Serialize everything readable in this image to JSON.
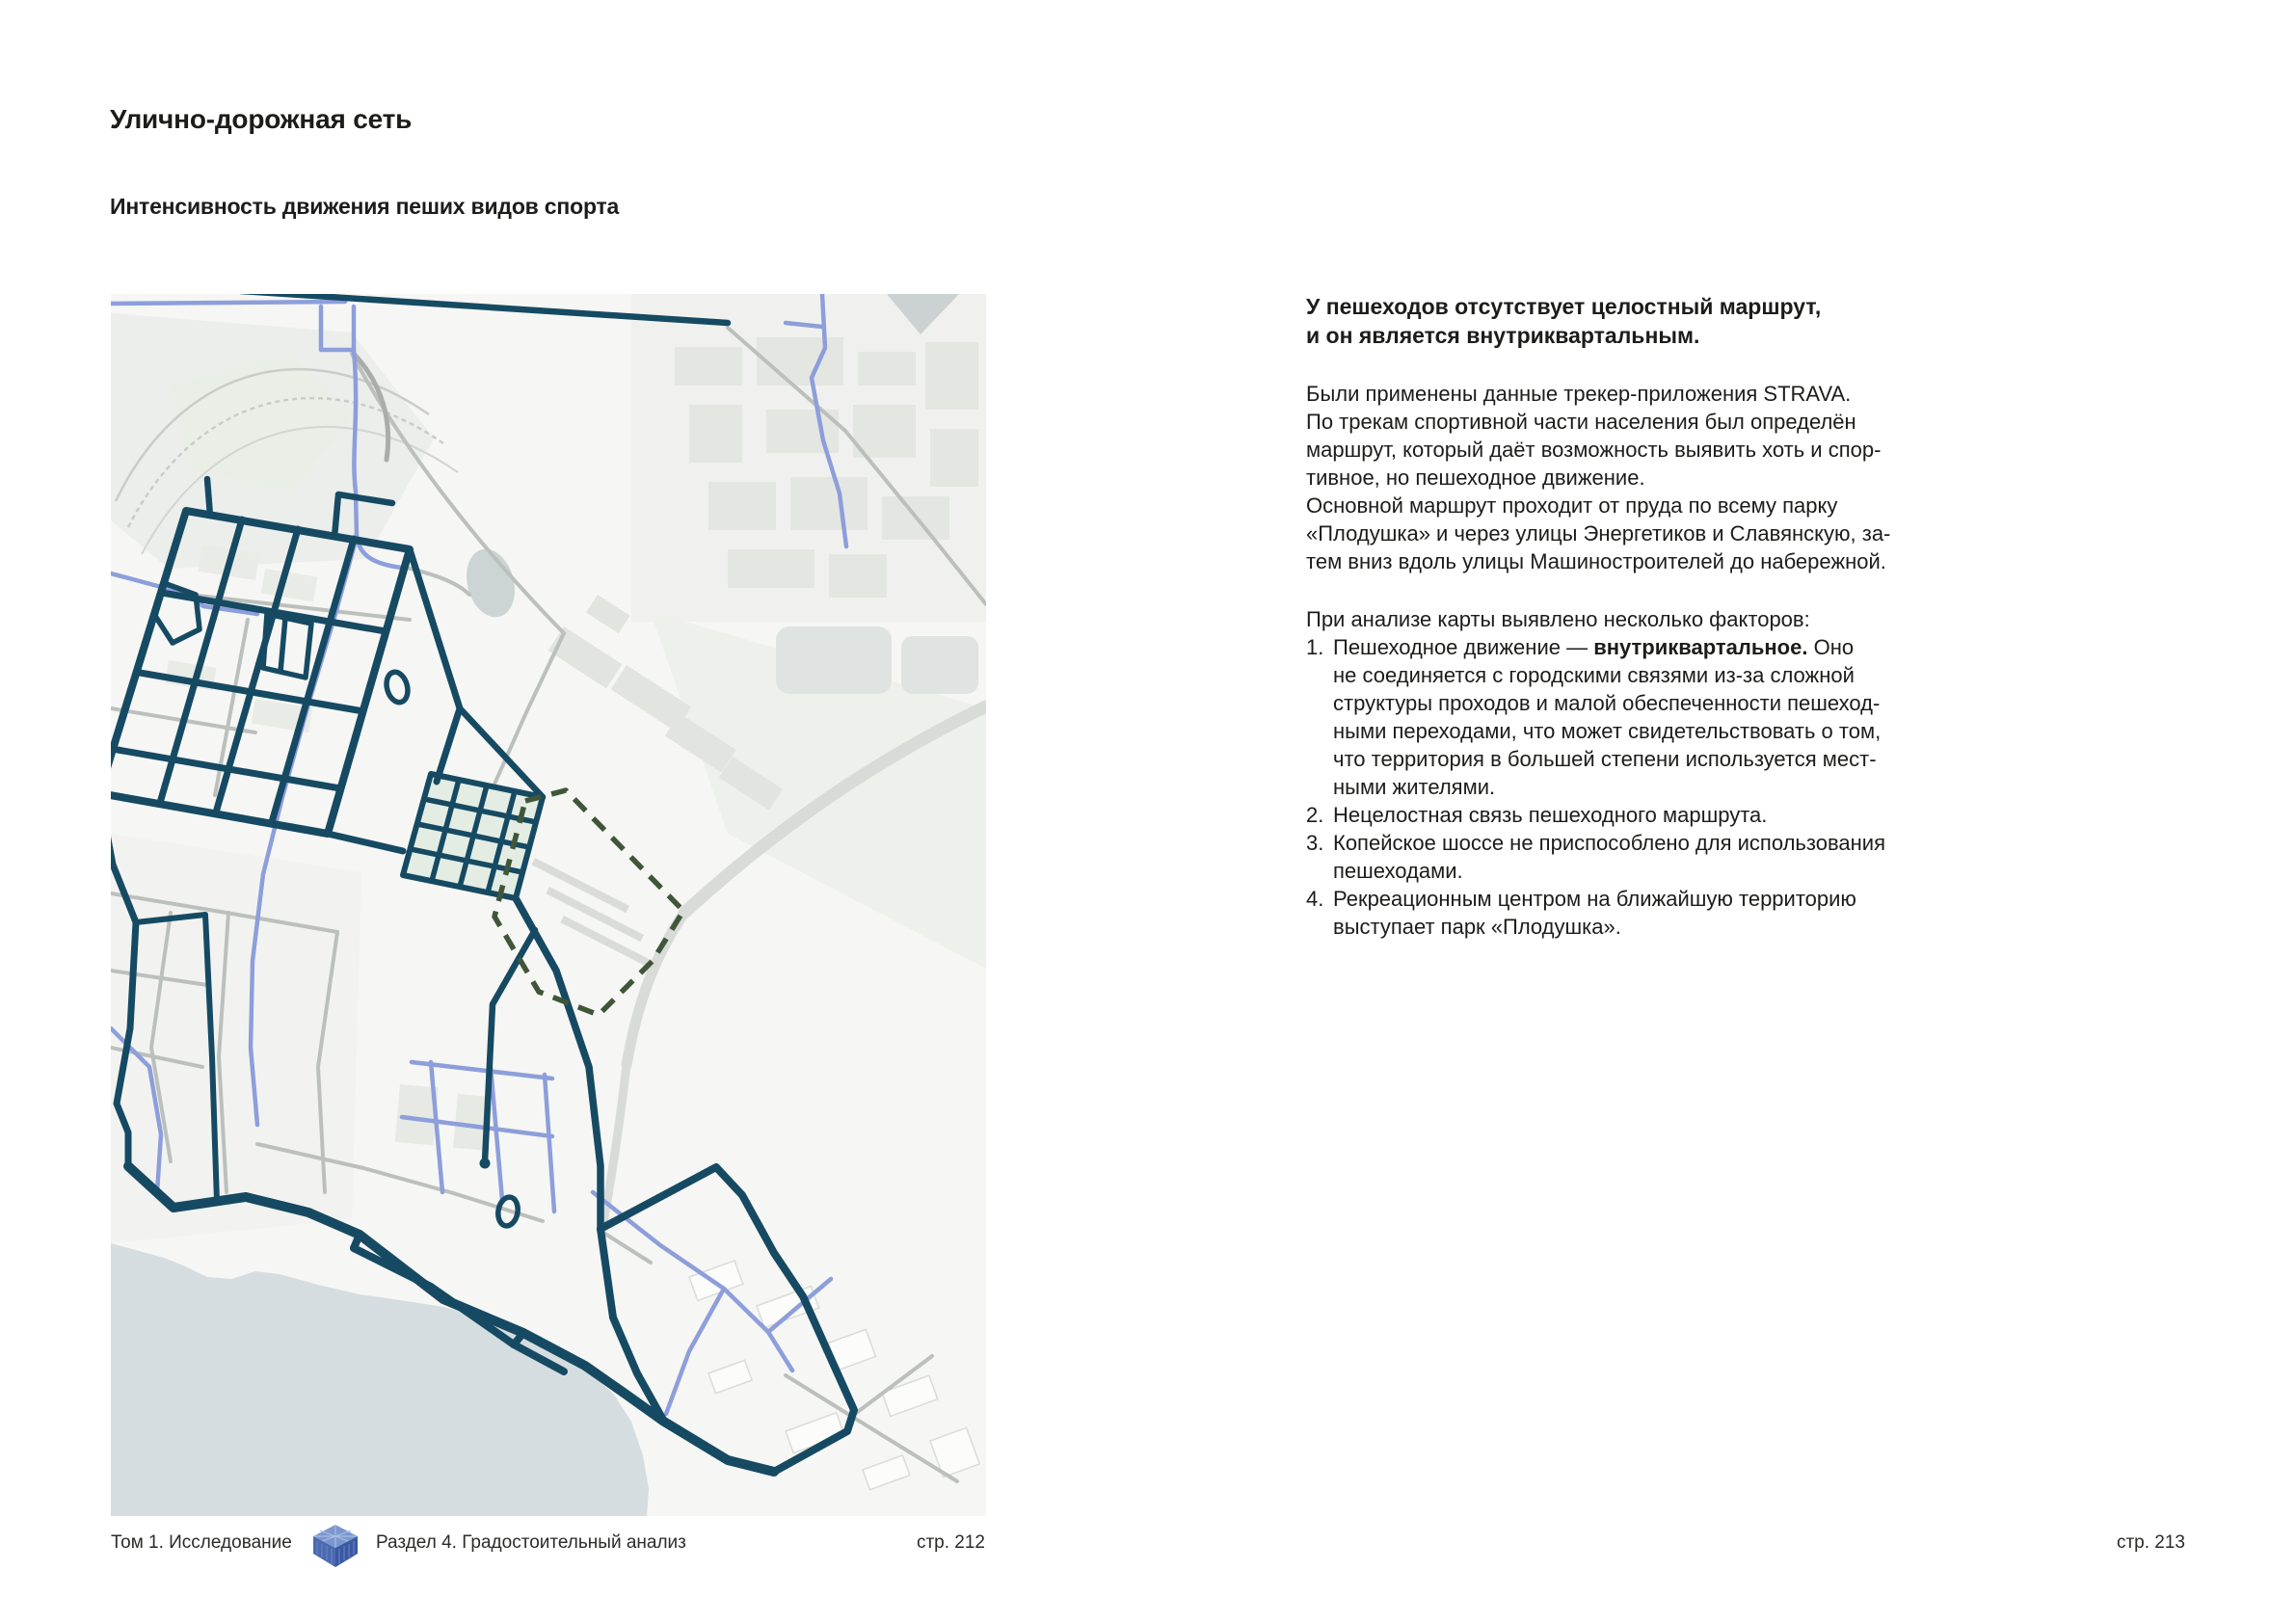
{
  "page": {
    "title": "Улично-дорожная сеть",
    "subtitle": "Интенсивность движения пеших видов спорта"
  },
  "article": {
    "lead": "У пешеходов отсутствует целостный маршрут,\nи он является внутриквартальным.",
    "paragraph": "Были применены данные трекер-приложения STRAVA.\nПо трекам спортивной части населения был определён\nмаршрут, который даёт возможность выявить хоть и спор-\nтивное, но пешеходное движение.\nОсновной маршрут проходит от пруда по всему парку\n«Плодушка» и через улицы Энергетиков и Славянскую, за-\nтем вниз вдоль улицы Машиностроителей до набережной.",
    "factors_intro": "При анализе карты выявлено несколько факторов:",
    "factors": [
      {
        "num": "1.",
        "prefix": "Пешеходное движение — ",
        "bold": "внутриквартальное.",
        "suffix": " Оно\nне соединяется с городскими связями из-за сложной\nструктуры проходов и малой обеспеченности пешеход-\nными переходами, что может свидетельствовать о том,\nчто территория в большей степени используется мест-\nными жителями."
      },
      {
        "num": "2.",
        "text": "Нецелостная связь пешеходного маршрута."
      },
      {
        "num": "3.",
        "text": "Копейское шоссе не приспособлено для использования\nпешеходами."
      },
      {
        "num": "4.",
        "text": "Рекреационным центром на ближайшую территорию\nвыступает парк «Плодушка»."
      }
    ]
  },
  "footer": {
    "volume": "Том 1. Исследование",
    "section": "Раздел 4. Градостоительный анализ",
    "page_left": "стр. 212",
    "page_right": "стр. 213",
    "logo_icon": "cube-logo"
  },
  "map": {
    "colors": {
      "strava_track": "#164a63",
      "street_light_blue": "#8d9edb",
      "street_gray": "#bcc0bc",
      "site_boundary_dashed": "#3f5638",
      "water": "#d5dde1",
      "park_green": "#e4ede4",
      "background": "#f6f6f4"
    }
  }
}
